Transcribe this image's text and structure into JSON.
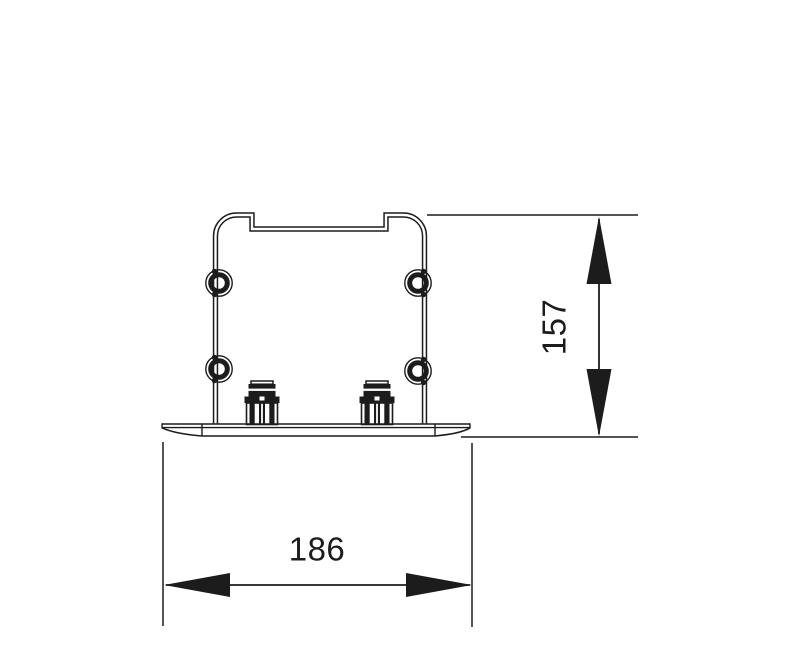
{
  "drawing": {
    "background_color": "#ffffff",
    "line_color": "#1c1c1c",
    "dimensions": {
      "height": {
        "value": "157",
        "orientation": "vertical"
      },
      "width": {
        "value": "186",
        "orientation": "horizontal"
      }
    }
  }
}
